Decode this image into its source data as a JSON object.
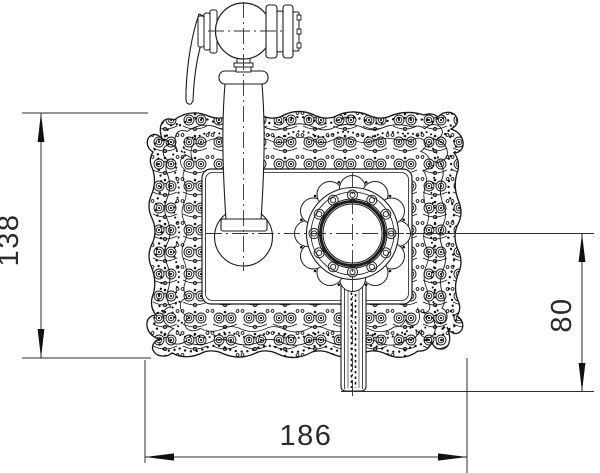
{
  "drawing": {
    "subject": "ornate-bidet-sprayer-faucet-with-decorative-back-plate",
    "style": "black-line technical drawing on white",
    "line_color": "#1c1c1c",
    "background_color": "#ffffff",
    "dimensions": {
      "plate_height": {
        "value": "138",
        "orientation": "vertical",
        "position": "left"
      },
      "handle_drop": {
        "value": "80",
        "orientation": "vertical",
        "position": "right"
      },
      "plate_width": {
        "value": "186",
        "orientation": "horizontal",
        "position": "bottom"
      }
    }
  }
}
